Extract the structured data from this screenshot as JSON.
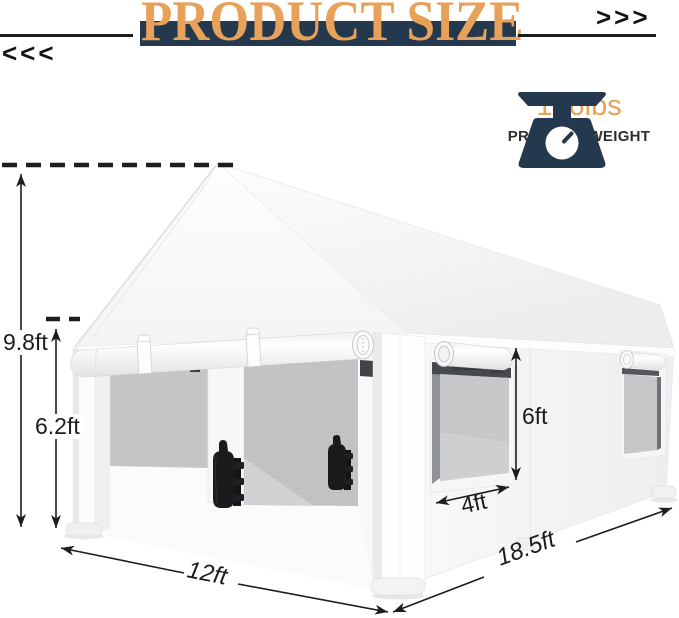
{
  "header": {
    "title": "PRODUCT SIZE",
    "left_chevrons": "<<<",
    "right_chevrons": ">>>"
  },
  "weight_badge": {
    "value": "136lbs",
    "label": "PRODUCT WEIGHT",
    "icon": "scale-icon"
  },
  "dimension_labels": {
    "peak_height": "9.8ft",
    "eave_height": "6.2ft",
    "window_height": "6ft",
    "window_width": "4ft",
    "front_width": "12ft",
    "side_depth": "18.5ft"
  },
  "colors": {
    "accent_orange": "#E8A158",
    "navy": "#24384E",
    "line_dark": "#1D1D1D"
  }
}
